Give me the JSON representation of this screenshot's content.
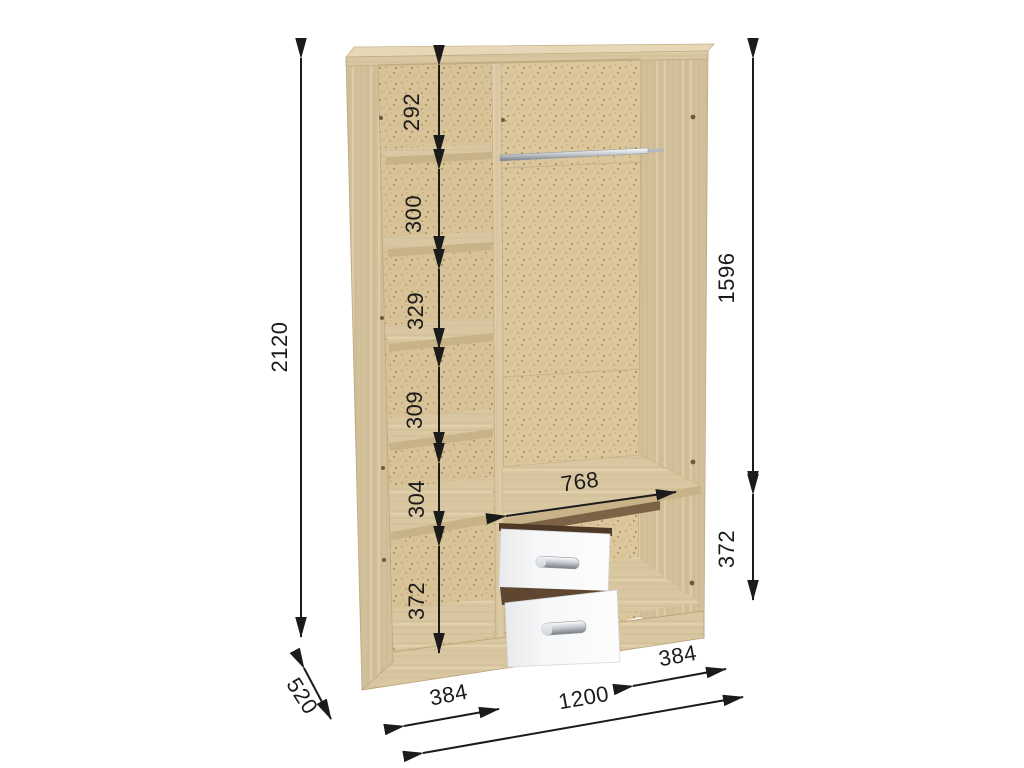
{
  "diagram": {
    "type": "furniture-dimension-diagram",
    "subject": "three-section wardrobe interior with shelves, hanging rod and two drawers",
    "units": "mm"
  },
  "dims": {
    "total_height": "2120",
    "total_width": "1200",
    "depth": "520",
    "left_column_width": "384",
    "right_section_width": "384",
    "hanging_section_width": "768",
    "hanging_section_height": "1596",
    "drawer_section_height": "372",
    "left_column_gaps": [
      "292",
      "300",
      "329",
      "309",
      "304",
      "372"
    ]
  },
  "colors": {
    "background": "#ffffff",
    "dimension_lines": "#1b1b1b",
    "wood_light": "#d9c8a2",
    "wood_panel": "#cfbd97",
    "chipboard_back": "#dcc79d",
    "drawer_front": "#f6f7f8",
    "chrome": "#c3c8cd"
  }
}
